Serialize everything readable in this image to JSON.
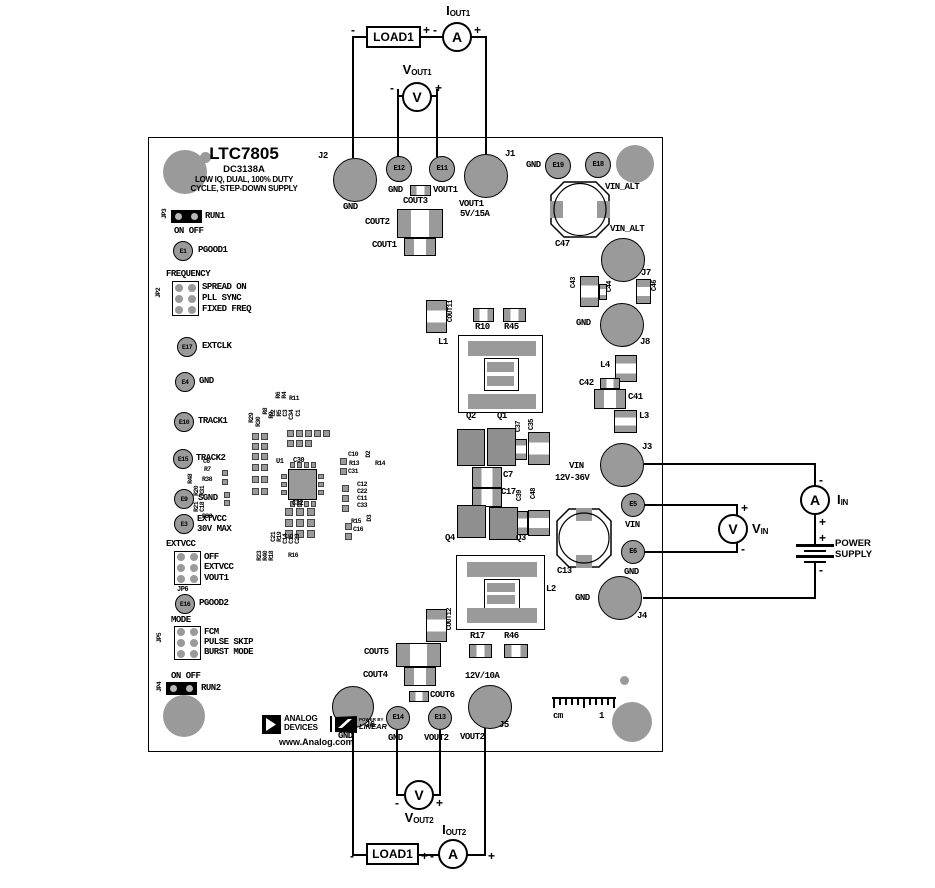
{
  "board": {
    "part_number": "LTC7805",
    "board_id": "DC3138A",
    "tagline1": "LOW IQ, DUAL, 100% DUTY",
    "tagline2": "CYCLE, STEP-DOWN SUPPLY",
    "website": "www.Analog.com"
  },
  "logos": {
    "adi1": "ANALOG",
    "adi2": "DEVICES",
    "lt_small": "POWER BY",
    "lt_big": "LINEAR"
  },
  "jumpers": {
    "jp3": {
      "id": "JP3",
      "signal": "RUN1",
      "states": "ON OFF"
    },
    "jp2": {
      "id": "JP2",
      "header": "FREQUENCY",
      "opt1": "SPREAD ON",
      "opt2": "PLL SYNC",
      "opt3": "FIXED FREQ"
    },
    "jp6": {
      "id": "JP6",
      "header": "EXTVCC",
      "opt1": "OFF",
      "opt2": "EXTVCC",
      "opt3": "VOUT1"
    },
    "jp5": {
      "id": "JP5",
      "header": "MODE",
      "opt1": "FCM",
      "opt2": "PULSE SKIP",
      "opt3": "BURST MODE"
    },
    "jp4": {
      "id": "JP4",
      "signal": "RUN2",
      "states": "ON OFF"
    }
  },
  "testpoints": {
    "e1": {
      "id": "E1",
      "label": "PGOOD1"
    },
    "e17": {
      "id": "E17",
      "label": "EXTCLK"
    },
    "e4": {
      "id": "E4",
      "label": "GND"
    },
    "e10": {
      "id": "E10",
      "label": "TRACK1"
    },
    "e15": {
      "id": "E15",
      "label": "TRACK2"
    },
    "e9": {
      "id": "E9",
      "label": "SGND"
    },
    "e3": {
      "id": "E3",
      "label1": "EXTVCC",
      "label2": "30V MAX"
    },
    "e16": {
      "id": "E16",
      "label": "PGOOD2"
    },
    "e12": {
      "id": "E12",
      "label": "GND"
    },
    "e11": {
      "id": "E11",
      "label": "VOUT1"
    },
    "e19": {
      "id": "E19",
      "label": "GND"
    },
    "e18": {
      "id": "E18",
      "label": "VIN_ALT"
    },
    "e5": {
      "id": "E5",
      "label": "VIN"
    },
    "e6": {
      "id": "E6",
      "label": "GND"
    },
    "e14": {
      "id": "E14",
      "label": "GND"
    },
    "e13": {
      "id": "E13",
      "label": "VOUT2"
    }
  },
  "connectors": {
    "j2": {
      "id": "J2",
      "label": "GND"
    },
    "j1": {
      "id": "J1",
      "label": "VOUT1",
      "rating": "5V/15A"
    },
    "j7": {
      "id": "J7",
      "label": "VIN_ALT"
    },
    "j8": {
      "id": "J8",
      "label": "GND"
    },
    "j3": {
      "id": "J3",
      "label": "VIN",
      "rating": "12V-36V"
    },
    "j4": {
      "id": "J4",
      "label": "GND"
    },
    "j6": {
      "id": "J6",
      "label": "GND"
    },
    "j5": {
      "id": "J5",
      "label": "VOUT2",
      "rating": "12V/10A"
    }
  },
  "refdes": {
    "cout1": "COUT1",
    "cout2": "COUT2",
    "cout3": "COUT3",
    "cout4": "COUT4",
    "cout5": "COUT5",
    "cout6": "COUT6",
    "cout11": "COUT11",
    "cout12": "COUT12",
    "r10": "R10",
    "r45": "R45",
    "r17": "R17",
    "r46": "R46",
    "l1": "L1",
    "l2": "L2",
    "l3": "L3",
    "l4": "L4",
    "q1": "Q1",
    "q2": "Q2",
    "q3": "Q3",
    "q4": "Q4",
    "c7": "C7",
    "c13": "C13",
    "c17": "C17",
    "c30": "C30",
    "c32": "C32",
    "c35": "C35",
    "c37": "C37",
    "c39": "C39",
    "c41": "C41",
    "c42": "C42",
    "c43": "C43",
    "c44": "C44",
    "c46": "C46",
    "c47": "C47",
    "c48": "C48",
    "u1": "U1",
    "r29": "R29",
    "r30": "R30",
    "r8": "R8",
    "r9": "R9",
    "r6": "R6",
    "r4": "R4",
    "r11": "R11",
    "c2": "C2",
    "r5": "R5",
    "c3": "C3",
    "c34": "C34",
    "c1": "C1",
    "c10": "C10",
    "r13": "R13",
    "r14": "R14",
    "c31": "C31",
    "d2": "D2",
    "c12": "C12",
    "c22": "C22",
    "c11": "C11",
    "c33": "C33",
    "r15": "R15",
    "c16": "C16",
    "d3": "D3",
    "c6": "C6",
    "r7": "R7",
    "r48": "R48",
    "r38": "R38",
    "r20": "R20",
    "r31": "R31",
    "r21": "R21",
    "c18": "C18",
    "r33": "R33",
    "c21": "C21",
    "r19": "R19",
    "c14": "C14",
    "c15": "C15",
    "c23": "C23",
    "r16": "R16",
    "r23": "R23",
    "r40": "R40",
    "r18": "R18"
  },
  "meters": {
    "iout1": {
      "sym": "A",
      "main": "I",
      "sub": "OUT1"
    },
    "vout1": {
      "sym": "V",
      "main": "V",
      "sub": "OUT1"
    },
    "iin": {
      "sym": "A",
      "main": "I",
      "sub": "IN"
    },
    "vin": {
      "sym": "V",
      "main": "V",
      "sub": "IN"
    },
    "vout2": {
      "sym": "V",
      "main": "V",
      "sub": "OUT2"
    },
    "iout2": {
      "sym": "A",
      "main": "I",
      "sub": "OUT2"
    }
  },
  "loads": {
    "top": "LOAD1",
    "bottom": "LOAD1"
  },
  "power_supply": {
    "line1": "POWER",
    "line2": "SUPPLY"
  },
  "signs": {
    "plus": "+",
    "minus": "-"
  },
  "ruler": {
    "unit": "cm",
    "mark": "1"
  }
}
